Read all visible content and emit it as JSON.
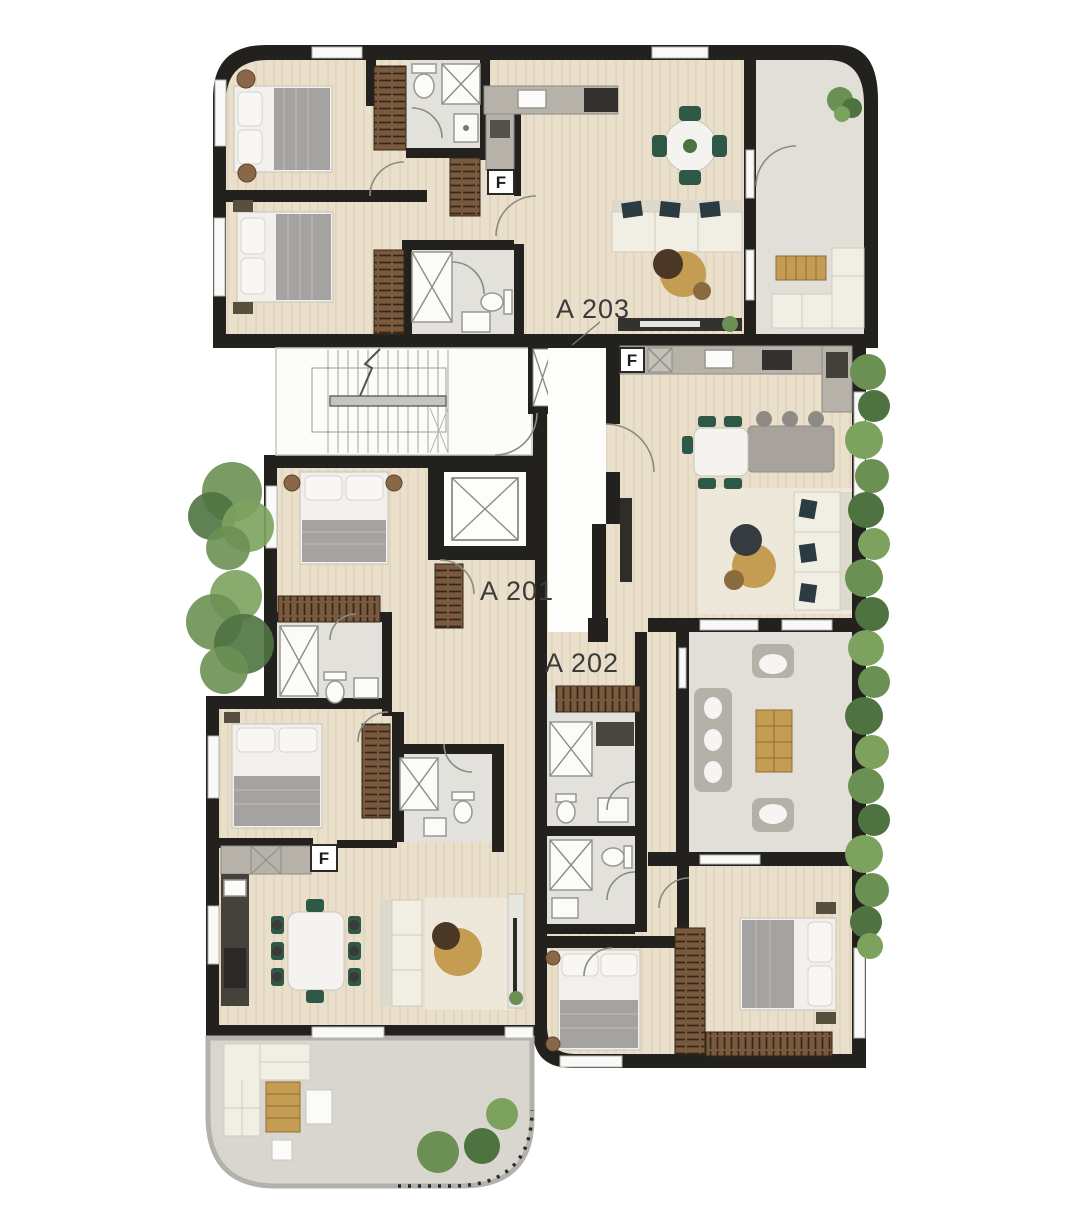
{
  "plan": {
    "apartments": {
      "a201": {
        "label": "A 201"
      },
      "a202": {
        "label": "A 202"
      },
      "a203": {
        "label": "A 203"
      }
    },
    "fridge_marker": "F",
    "colors": {
      "wall": "#23211d",
      "wood_floor": "#e9dfca",
      "tile_floor": "#e3e1db",
      "terrace_floor": "#d9d6cf",
      "balcony_floor": "#e2dfd8",
      "rug": "#eee8da",
      "stair_white": "#fcfcfb",
      "wardrobe": "#7a5a3e",
      "wardrobe_line": "#342718",
      "bed_gray": "#a4a3a1",
      "linen": "#f2f0ec",
      "sofa_cream": "#f1eee4",
      "sofa_shade": "#ddd9cc",
      "pillow_dark": "#2c3a41",
      "table_tan": "#c49c52",
      "table_brown": "#8a6a3f",
      "table_dark": "#4a3725",
      "plant_green": "#6b9053",
      "plant_dark": "#4f7340",
      "chair_green": "#2f5947",
      "counter_gray": "#b6b2aa",
      "counter_dark": "#34322e",
      "island_gray": "#a7a39c",
      "outdoor_gray": "#b4b1a8",
      "window": "#f9f9f7",
      "fixture_stroke": "#9a978f",
      "label_ink": "#3b3b3b"
    }
  }
}
